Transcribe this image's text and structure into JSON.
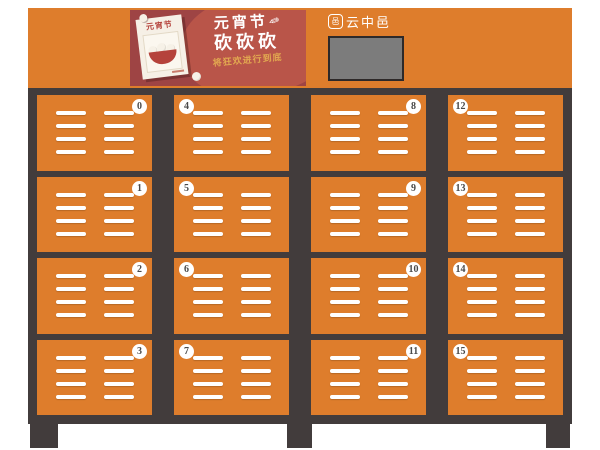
{
  "brand": {
    "name": "云中邑"
  },
  "poster": {
    "calendar_title": "元宵节",
    "headline_line1": "元宵节",
    "headline_line2": "砍砍砍",
    "subtitle": "将狂欢进行到底"
  },
  "lockers": {
    "door_numbers": [
      "0",
      "1",
      "2",
      "3",
      "4",
      "5",
      "6",
      "7",
      "8",
      "9",
      "10",
      "11",
      "12",
      "13",
      "14",
      "15"
    ]
  },
  "colors": {
    "cabinet_orange": "#DE7D2C",
    "frame_dark": "#423C3C",
    "poster_background": "#9E4444",
    "poster_blob": "#B95549",
    "poster_subtitle_gold": "#E2A850",
    "screen_gray": "#7C7C7C",
    "badge_text": "#4A4A4A"
  }
}
